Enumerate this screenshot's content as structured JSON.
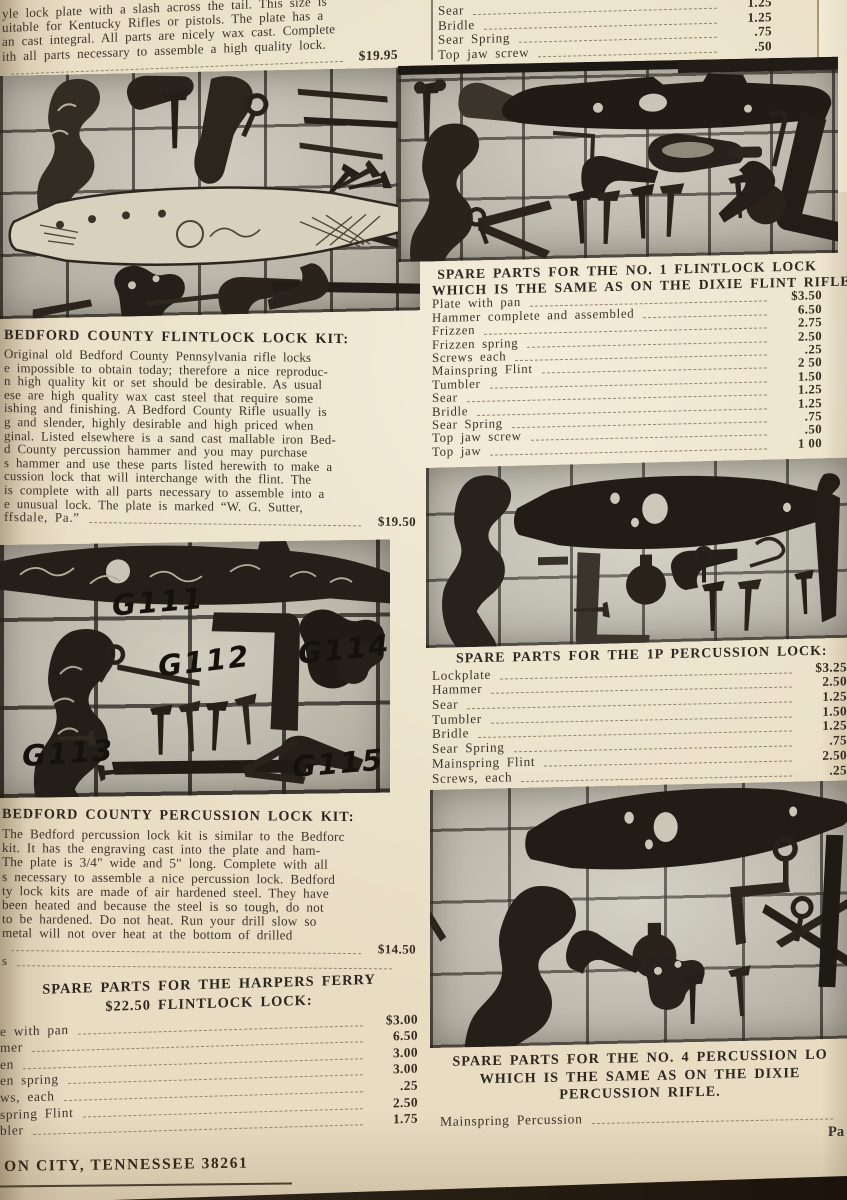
{
  "colors": {
    "paper": "#e8ddc3",
    "ink": "#3c332a",
    "photo_background": "#c7c3b5",
    "photo_ink": "#231e17"
  },
  "intro": {
    "lines": [
      "yle lock plate with a slash across the tail.  This size is",
      "uitable for Kentucky Rifles or pistols.  The plate has a",
      "an cast integral.  All parts are nicely wax cast.  Complete",
      "ith all parts necessary to assemble a high quality lock."
    ],
    "price": "$19.95"
  },
  "top_right_list": {
    "rows": [
      {
        "label": "Sear",
        "price": "1.25"
      },
      {
        "label": "Bridle",
        "price": "1.25"
      },
      {
        "label": "Sear Spring",
        "price": ".75"
      },
      {
        "label": "Top jaw screw",
        "price": ".50"
      }
    ]
  },
  "bedford_flintlock": {
    "heading": "BEDFORD COUNTY FLINTLOCK LOCK KIT:",
    "lines": [
      "Original old Bedford County Pennsylvania rifle locks",
      "e impossible to obtain today; therefore a nice reproduc-",
      "n high quality kit or set should be desirable.  As usual",
      "ese are high quality wax cast steel that require some",
      "ishing and finishing.  A Bedford County Rifle usually is",
      "g and slender, highly desirable and high priced when",
      "ginal.  Listed elsewhere is a sand cast mallable iron Bed-",
      "d County percussion hammer and you may purchase",
      "s hammer and use these parts listed herewith to make a",
      "cussion lock that will interchange with the flint.  The",
      "is complete with all parts necessary to assemble into a",
      "e unusual lock.  The plate is marked “W. G. Sutter,"
    ],
    "tail": "ffsdale, Pa.”",
    "price": "$19.50"
  },
  "g_photo": {
    "labels": [
      "G111",
      "G112",
      "G113",
      "G114",
      "G115"
    ]
  },
  "bedford_percussion": {
    "heading": "BEDFORD COUNTY PERCUSSION LOCK KIT:",
    "lines": [
      "The Bedford percussion lock kit is similar to the Bedforc",
      "kit.  It has the engraving cast into the plate and ham-",
      "The plate is 3/4\" wide and 5\" long.  Complete with all",
      "s necessary to assemble a nice percussion lock.  Bedford",
      "ty lock kits are made of air hardened steel.  They have",
      "been heated and because the steel is so tough, do not",
      "to be hardened.  Do not heat.  Run your drill slow so",
      "metal will not over heat at the bottom of drilled"
    ],
    "price": "$14.50",
    "stray": "s"
  },
  "harpers": {
    "heading_line1": "SPARE PARTS FOR THE HARPERS FERRY",
    "heading_line2": "$22.50 FLINTLOCK LOCK:",
    "rows": [
      {
        "label": "e with pan",
        "price": "$3.00"
      },
      {
        "label": "mer",
        "price": "6.50"
      },
      {
        "label": "en",
        "price": "3.00"
      },
      {
        "label": "en spring",
        "price": "3.00"
      },
      {
        "label": "ws, each",
        "price": ".25"
      },
      {
        "label": "spring Flint",
        "price": "2.50"
      },
      {
        "label": "bler",
        "price": "1.75"
      }
    ]
  },
  "no1": {
    "heading_line1": "SPARE PARTS FOR THE NO. 1 FLINTLOCK LOCK",
    "heading_line2": "WHICH IS THE SAME AS ON THE DIXIE FLINT RIFLE.",
    "rows": [
      {
        "label": "Plate with pan",
        "price": "$3.50"
      },
      {
        "label": "Hammer complete and assembled",
        "price": "6.50"
      },
      {
        "label": "Frizzen",
        "price": "2.75"
      },
      {
        "label": "Frizzen spring",
        "price": "2.50"
      },
      {
        "label": "Screws each",
        "price": ".25"
      },
      {
        "label": "Mainspring Flint",
        "price": "2 50"
      },
      {
        "label": "Tumbler",
        "price": "1.50"
      },
      {
        "label": "Sear",
        "price": "1.25"
      },
      {
        "label": "Bridle",
        "price": "1.25"
      },
      {
        "label": "Sear Spring",
        "price": ".75"
      },
      {
        "label": "Top jaw screw",
        "price": ".50"
      },
      {
        "label": "Top jaw",
        "price": "1 00"
      }
    ]
  },
  "p1": {
    "heading": "SPARE PARTS FOR THE 1P PERCUSSION LOCK:",
    "rows": [
      {
        "label": "Lockplate",
        "price": "$3.25"
      },
      {
        "label": "Hammer",
        "price": "2.50"
      },
      {
        "label": "Sear",
        "price": "1.25"
      },
      {
        "label": "Tumbler",
        "price": "1.50"
      },
      {
        "label": "Bridle",
        "price": "1.25"
      },
      {
        "label": "Sear Spring",
        "price": ".75"
      },
      {
        "label": "Mainspring Flint",
        "price": "2.50"
      },
      {
        "label": "Screws, each",
        "price": ".25"
      }
    ]
  },
  "no4": {
    "heading_line1": "SPARE PARTS FOR THE NO. 4 PERCUSSION LO",
    "heading_line2": "WHICH IS THE SAME AS ON THE DIXIE",
    "heading_line3": "PERCUSSION RIFLE.",
    "rows": [
      {
        "label": "Mainspring Percussion",
        "price": ""
      }
    ]
  },
  "footer": {
    "address": "ON CITY, TENNESSEE 38261",
    "page_ref": "Pa"
  }
}
